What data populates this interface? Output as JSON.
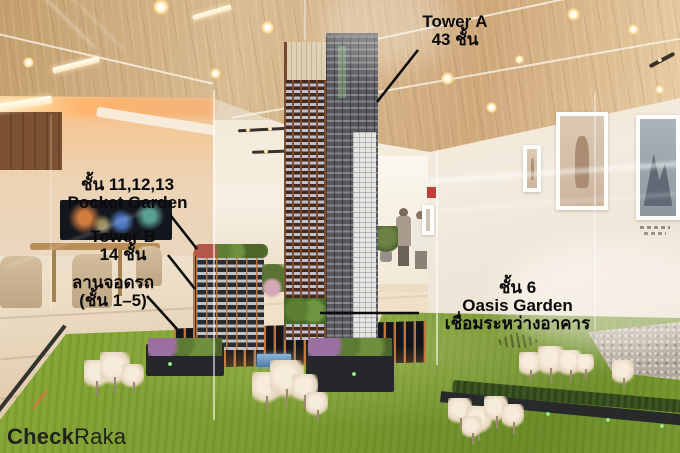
{
  "annotations": {
    "tower_a": {
      "line1": "Tower A",
      "line2": "43 ชั้น"
    },
    "pocket_garden": {
      "line1": "ชั้น 11,12,13",
      "line2": "Pocket Garden"
    },
    "tower_b": {
      "line1": "Tower B",
      "line2": "14 ชั้น"
    },
    "parking": {
      "line1": "ลานจอดรถ",
      "line2": "(ชั้น 1–5)"
    },
    "oasis_garden": {
      "line1": "ชั้น 6",
      "line2": "Oasis Garden",
      "line3": "เชื่อมระหว่างอาคาร"
    }
  },
  "watermark": {
    "bold": "Check",
    "light": "Raka"
  },
  "photo": {
    "subject": "Scale model of condominium towers on green turf inside a glass case in a sales gallery",
    "colors": {
      "annotation_text": "#0a0a0a",
      "turf_green": "#7c9c31",
      "ceiling_wood": "#d2b286",
      "tower_dark": "#57585c",
      "window_frame_orange": "#c1793f",
      "floor_beige": "#e6d5bd"
    }
  }
}
